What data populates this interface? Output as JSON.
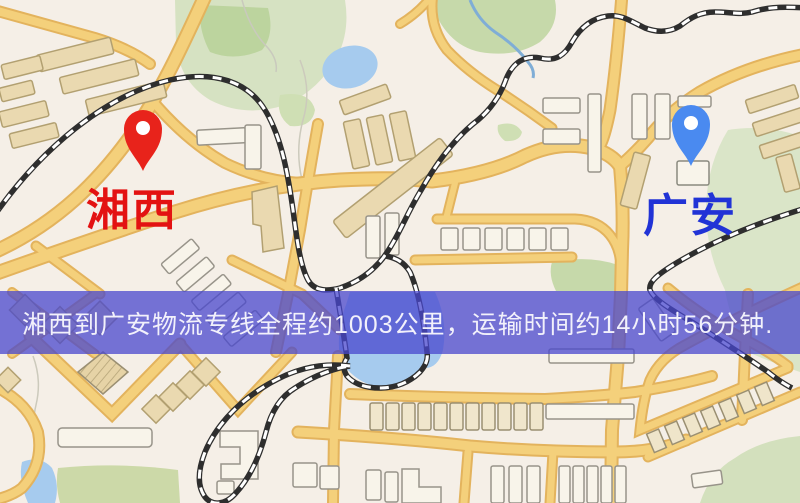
{
  "banner": {
    "text": "湘西到广安物流专线全程约1003公里，运输时间约14小时56分钟.",
    "distance": "1003公里",
    "duration": "14小时56分钟",
    "bg_color": "#4847CD",
    "text_color": "#F2F1FB"
  },
  "markers": {
    "origin": {
      "label": "湘西",
      "label_color": "#E31212",
      "pin_color": "#E8231B"
    },
    "destination": {
      "label": "广安",
      "label_color": "#2133D6",
      "pin_color": "#4A8AF0"
    }
  },
  "map": {
    "colors": {
      "background": "#F5EFE7",
      "road_fill": "#F4D07B",
      "road_casing": "#E3B35D",
      "building_tan": "#EAD9B0",
      "building_light": "#F8F4EA",
      "park_green": "#D6E2C2",
      "park_green_dark": "#BCD49E",
      "water_blue": "#A6CBEE",
      "railway": "#2E2E2E"
    }
  }
}
